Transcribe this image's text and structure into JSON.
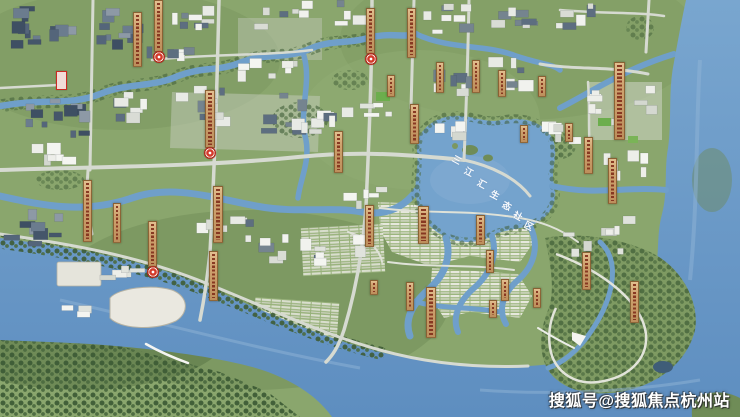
{
  "meta": {
    "description": "Aerial bird's-eye master-plan rendering of a riverside planned community with central lake"
  },
  "watermark": {
    "text": "搜狐号@搜狐焦点杭州站"
  },
  "lake_label": {
    "text": "三江汇生态社区",
    "chars": [
      "三",
      "江",
      "汇",
      "生",
      "态",
      "社",
      "区"
    ],
    "positions": [
      [
        452,
        156
      ],
      [
        464,
        168
      ],
      [
        477,
        180
      ],
      [
        490,
        191
      ],
      [
        502,
        202
      ],
      [
        513,
        212
      ],
      [
        524,
        222
      ]
    ]
  },
  "map": {
    "colors": {
      "water": "#6f9fca",
      "water_deep": "#5e8ec0",
      "land": "#8aa66d",
      "trees": "#3f5e35",
      "road": "#d6dad1",
      "building_light": "#edeee9",
      "building_dark": "#54657a",
      "banner_bg": "#cfa36f",
      "banner_text": "#8c3b26",
      "seal_red": "#d4392a"
    },
    "markers": [
      {
        "x": 133,
        "y": 12,
        "w": 9,
        "h": 55,
        "seal": false
      },
      {
        "x": 154,
        "y": 0,
        "w": 9,
        "h": 52,
        "seal": true
      },
      {
        "x": 205,
        "y": 90,
        "w": 10,
        "h": 58,
        "seal": true
      },
      {
        "x": 334,
        "y": 131,
        "w": 9,
        "h": 42,
        "seal": false
      },
      {
        "x": 83,
        "y": 180,
        "w": 9,
        "h": 62,
        "seal": false
      },
      {
        "x": 113,
        "y": 203,
        "w": 8,
        "h": 40,
        "seal": false
      },
      {
        "x": 213,
        "y": 186,
        "w": 10,
        "h": 57,
        "seal": false
      },
      {
        "x": 209,
        "y": 251,
        "w": 9,
        "h": 50,
        "seal": false
      },
      {
        "x": 148,
        "y": 221,
        "w": 9,
        "h": 46,
        "seal": true
      },
      {
        "x": 366,
        "y": 8,
        "w": 9,
        "h": 46,
        "seal": true
      },
      {
        "x": 407,
        "y": 8,
        "w": 9,
        "h": 50,
        "seal": false
      },
      {
        "x": 387,
        "y": 75,
        "w": 8,
        "h": 22,
        "seal": false
      },
      {
        "x": 410,
        "y": 104,
        "w": 9,
        "h": 40,
        "seal": false
      },
      {
        "x": 436,
        "y": 62,
        "w": 8,
        "h": 31,
        "seal": false
      },
      {
        "x": 472,
        "y": 60,
        "w": 8,
        "h": 33,
        "seal": false
      },
      {
        "x": 498,
        "y": 70,
        "w": 8,
        "h": 27,
        "seal": false
      },
      {
        "x": 538,
        "y": 76,
        "w": 8,
        "h": 21,
        "seal": false
      },
      {
        "x": 614,
        "y": 62,
        "w": 11,
        "h": 78,
        "seal": false
      },
      {
        "x": 520,
        "y": 125,
        "w": 8,
        "h": 18,
        "seal": false
      },
      {
        "x": 565,
        "y": 123,
        "w": 8,
        "h": 19,
        "seal": false
      },
      {
        "x": 584,
        "y": 137,
        "w": 9,
        "h": 37,
        "seal": false
      },
      {
        "x": 608,
        "y": 158,
        "w": 9,
        "h": 46,
        "seal": false
      },
      {
        "x": 365,
        "y": 205,
        "w": 9,
        "h": 42,
        "seal": false
      },
      {
        "x": 418,
        "y": 206,
        "w": 11,
        "h": 38,
        "seal": false
      },
      {
        "x": 476,
        "y": 215,
        "w": 9,
        "h": 30,
        "seal": false
      },
      {
        "x": 486,
        "y": 250,
        "w": 8,
        "h": 23,
        "seal": false
      },
      {
        "x": 501,
        "y": 279,
        "w": 8,
        "h": 22,
        "seal": false
      },
      {
        "x": 533,
        "y": 288,
        "w": 8,
        "h": 20,
        "seal": false
      },
      {
        "x": 489,
        "y": 300,
        "w": 8,
        "h": 18,
        "seal": false
      },
      {
        "x": 406,
        "y": 282,
        "w": 8,
        "h": 29,
        "seal": false
      },
      {
        "x": 426,
        "y": 287,
        "w": 10,
        "h": 51,
        "seal": false
      },
      {
        "x": 582,
        "y": 252,
        "w": 9,
        "h": 38,
        "seal": false
      },
      {
        "x": 630,
        "y": 281,
        "w": 9,
        "h": 42,
        "seal": false
      },
      {
        "x": 370,
        "y": 280,
        "w": 8,
        "h": 15,
        "seal": false
      }
    ],
    "signs": [
      {
        "x": 56,
        "y": 71,
        "w": 11,
        "h": 19,
        "type": "red-outlined-billboard"
      }
    ]
  }
}
